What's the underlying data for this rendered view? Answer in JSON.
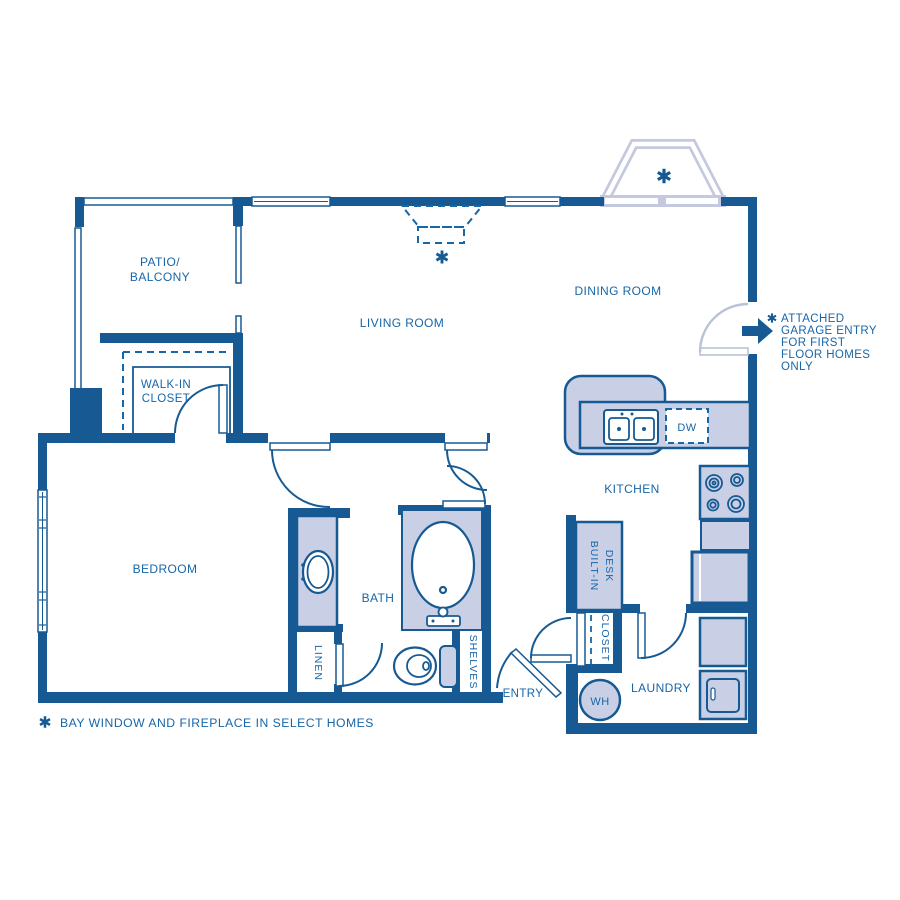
{
  "colors": {
    "wall": "#175a93",
    "label": "#1766a8",
    "fixture_fill": "#c9d0e6",
    "bay_window": "#c4c9e0",
    "light_door": "#b9c2d8",
    "background": "#ffffff"
  },
  "labels": {
    "patio_balcony": [
      "PATIO/",
      "BALCONY"
    ],
    "living_room": "LIVING ROOM",
    "dining_room": "DINING ROOM",
    "walk_in_closet": [
      "WALK-IN",
      "CLOSET"
    ],
    "bedroom": "BEDROOM",
    "bath": "BATH",
    "kitchen": "KITCHEN",
    "laundry": "LAUNDRY",
    "entry": "ENTRY",
    "linen": "LINEN",
    "shelves": "SHELVES",
    "closet": "CLOSET",
    "built_in_desk": [
      "BUILT-IN",
      "DESK"
    ],
    "dishwasher": "DW",
    "water_heater": "WH"
  },
  "annotations": {
    "garage_entry": [
      "ATTACHED",
      "GARAGE ENTRY",
      "FOR FIRST",
      "FLOOR HOMES",
      "ONLY"
    ],
    "footnote": "BAY WINDOW AND FIREPLACE IN SELECT HOMES"
  }
}
